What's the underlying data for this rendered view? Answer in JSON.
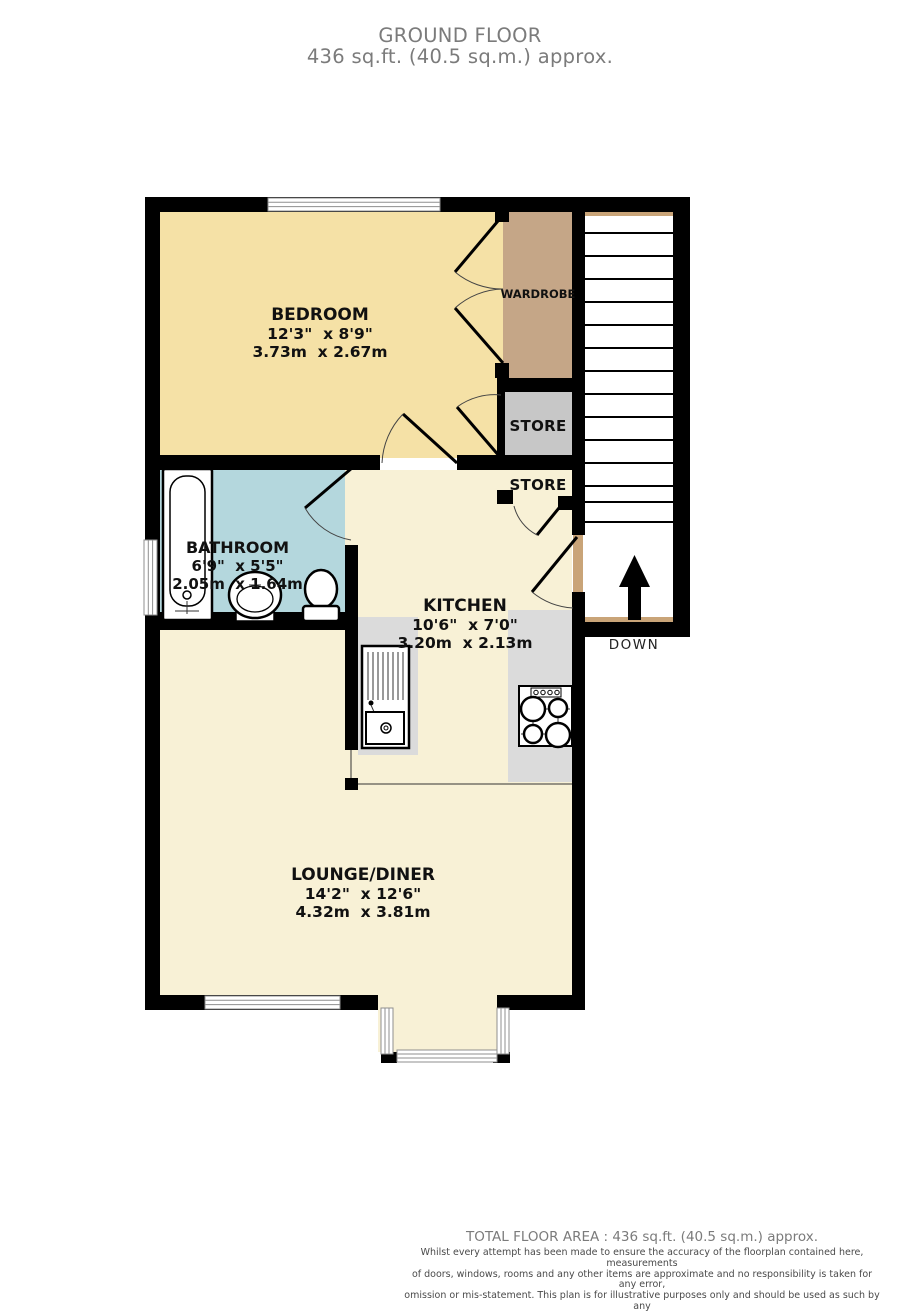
{
  "title": {
    "floor_name": "GROUND FLOOR",
    "floor_area": "436 sq.ft. (40.5 sq.m.) approx."
  },
  "rooms": {
    "bedroom": {
      "name": "BEDROOM",
      "dims_imperial": "12'3\"  x 8'9\"",
      "dims_metric": "3.73m  x 2.67m"
    },
    "bathroom": {
      "name": "BATHROOM",
      "dims_imperial": "6'9\"  x 5'5\"",
      "dims_metric": "2.05m  x 1.64m"
    },
    "kitchen": {
      "name": "KITCHEN",
      "dims_imperial": "10'6\"  x 7'0\"",
      "dims_metric": "3.20m  x 2.13m"
    },
    "lounge": {
      "name": "LOUNGE/DINER",
      "dims_imperial": "14'2\"  x 12'6\"",
      "dims_metric": "4.32m  x 3.81m"
    },
    "wardrobe": {
      "name": "WARDROBE"
    },
    "store_upper": {
      "name": "STORE"
    },
    "store_lower": {
      "name": "STORE"
    }
  },
  "stairs": {
    "direction_label": "DOWN"
  },
  "footer": {
    "total_area": "TOTAL FLOOR AREA : 436 sq.ft. (40.5 sq.m.) approx.",
    "disclaimer_lines": [
      "Whilst every attempt has been made to ensure the accuracy of the floorplan contained here, measurements",
      "of doors, windows, rooms and any other items are approximate and no responsibility is taken for any error,",
      "omission or mis-statement. This plan is for illustrative purposes only and should be used as such by any",
      "prospective purchaser. The services, systems and appliances shown have not been tested and no guarantee",
      "as to their operability or efficiency can be given."
    ],
    "credit": "Made with Metropix ©2025"
  },
  "colors": {
    "bedroom": "#F5E1A6",
    "living": "#F8F1D6",
    "bathroom": "#B4D7DD",
    "wardrobe": "#C5A687",
    "store": "#C7C7C7",
    "counter": "#DBDBDB",
    "stair_edge": "#C9A478",
    "wall": "#000000",
    "window_line": "#8F8F8F",
    "door_arc": "#444444",
    "title_text": "#7B7B7B",
    "disclaimer_text": "#4A4A4A",
    "label_text": "#111111"
  }
}
